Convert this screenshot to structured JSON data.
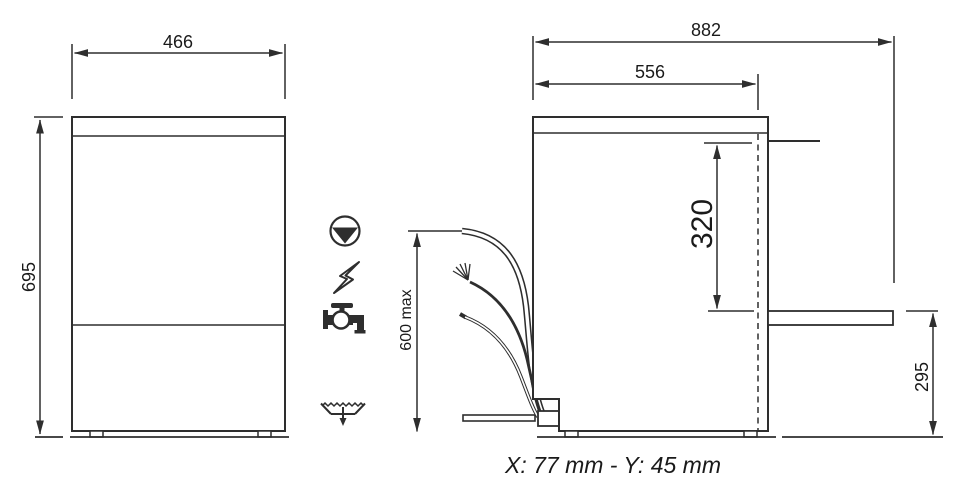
{
  "page": {
    "background": "#ffffff",
    "width_px": 969,
    "height_px": 496
  },
  "drawing": {
    "caption": "X: 77 mm - Y: 45 mm",
    "front_view": {
      "width_dim": "466",
      "height_dim": "695"
    },
    "side_view": {
      "overall_depth_dim": "882",
      "body_depth_dim": "556",
      "rear_clearance_dim": "320",
      "outlet_height_dim": "295",
      "connection_x": "X",
      "connection_y": "Y"
    },
    "connections": {
      "max_length_dim": "600 max",
      "icons": [
        {
          "name": "drain-pump-icon"
        },
        {
          "name": "electricity-icon"
        },
        {
          "name": "water-tap-icon"
        },
        {
          "name": "floor-drain-icon"
        }
      ]
    },
    "colors": {
      "line": "#2e2e2e",
      "text": "#1a1a1a"
    }
  }
}
